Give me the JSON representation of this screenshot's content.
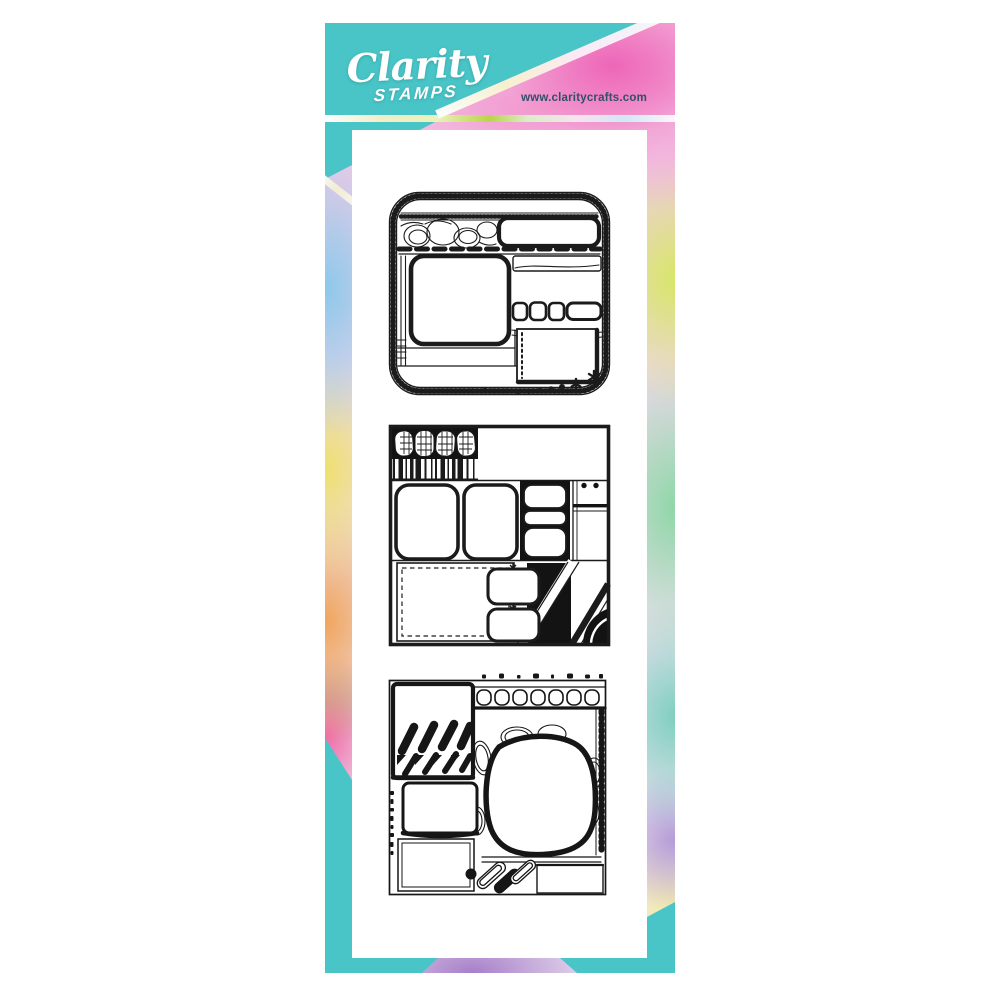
{
  "page": {
    "background": "#ffffff",
    "description": "Product image of a Clarity Stamps slimline clear-stamp set: a tall teal and tie-dye watercolour backing card with a white stamp sheet carrying three black doodle scrapbook-layout square stamps."
  },
  "brand": {
    "name": "Clarity",
    "subtitle": "STAMPS",
    "website": "www.claritycrafts.com"
  },
  "colors": {
    "teal": "#49c5c7",
    "ink": "#1b1b1b",
    "webtext": "#31506a",
    "panel": "#ffffff",
    "watercolor": {
      "pink": "#f29ad0",
      "magenta": "#ee66b8",
      "blue": "#8cc8ea",
      "yellow": "#efe06e",
      "orange": "#f0a55c",
      "hotpink": "#ef6aa8",
      "lime": "#d8e668",
      "green": "#8fd7a8",
      "tealgreen": "#7fcfc0",
      "lavender": "#b49bd8",
      "cream": "#f2eca8",
      "purple": "#a77fc9"
    },
    "holo_stripe": [
      "#fdfdfd",
      "#f3edc8",
      "#bcd34a",
      "#f6e3ee",
      "#cfe9f4"
    ]
  },
  "stamps": [
    {
      "id": "design-1",
      "description": "Rounded square layout stamp with stitched film-strip border, tick band, arc doodle header, bold rounded label box, thick dashed divider, large photo frame, banner, tab row and dotted-edge photo block trailed by a dot-and-flower garland"
    },
    {
      "id": "design-2",
      "description": "Square layout stamp with plaid pebble header on black, barcode strip, two large rounded photo frames, three tabs on a black block, ruled side column, dashed journaling box, linked mini frames and diagonal striped black corner"
    },
    {
      "id": "design-3",
      "description": "Square layout stamp with bold brush-stroke and checker panel, arched film-strip header, dotted edges, large organic photo blob among outlined pebbles, stacked photo frames and a striped leaf cluster with solid dot"
    }
  ]
}
